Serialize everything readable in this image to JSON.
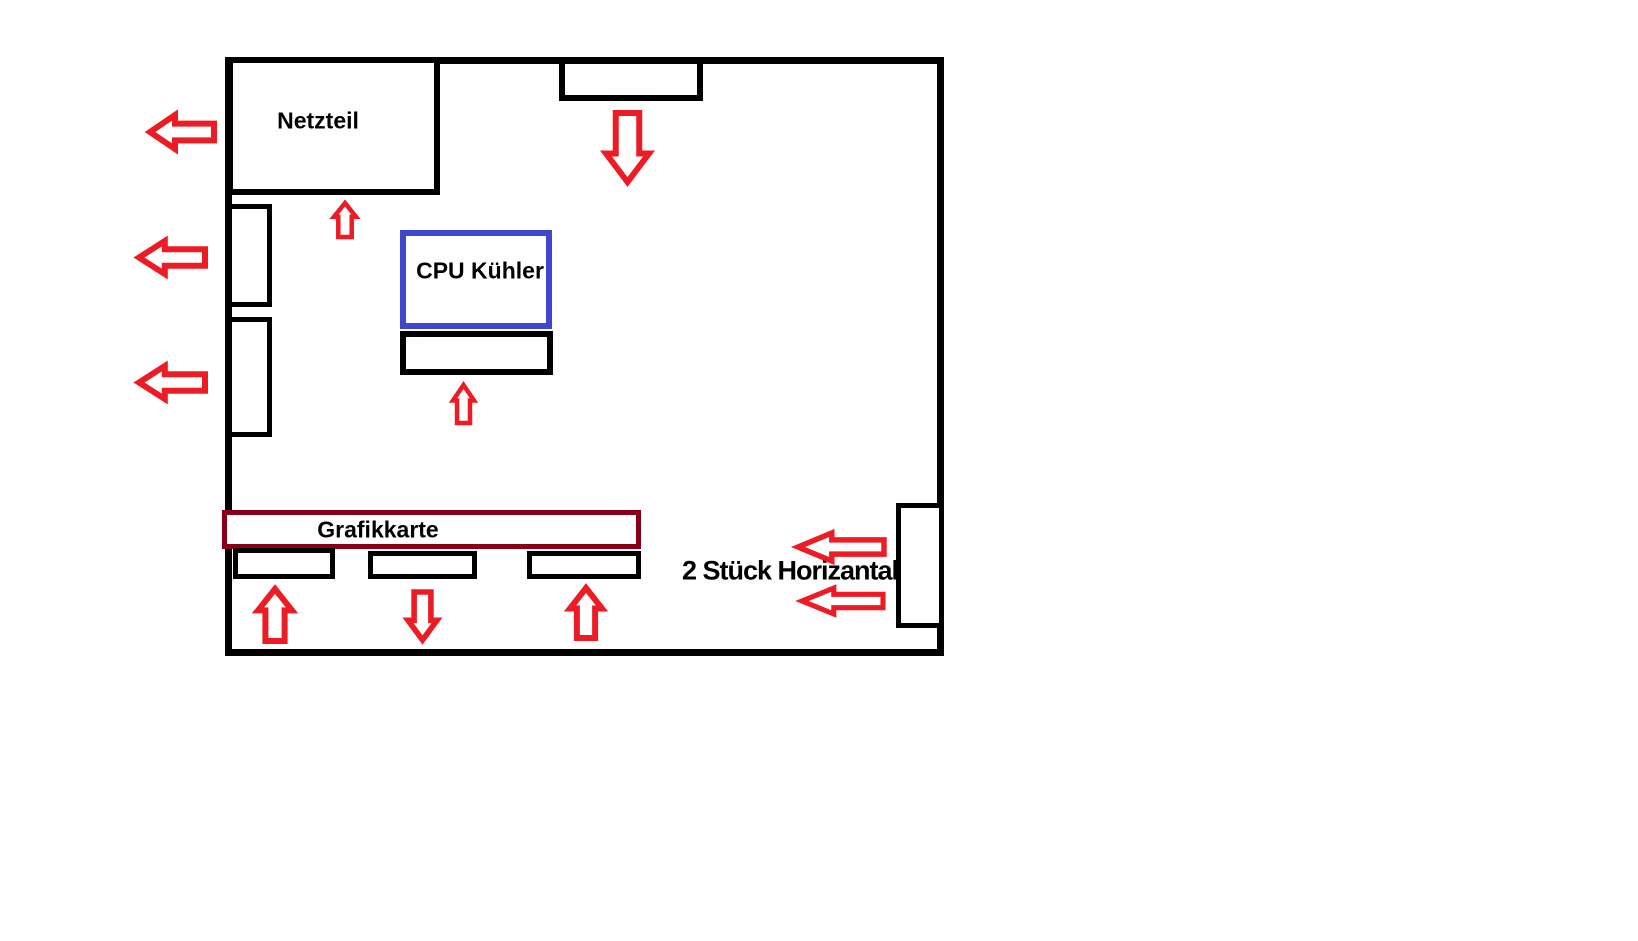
{
  "diagram": {
    "title": "pc-case-airflow-sketch",
    "labels": {
      "psu": "Netzteil",
      "cpu_cooler": "CPU Kühler",
      "gpu": "Grafikkarte",
      "side_note": "2 Stück Horizantal"
    },
    "colors": {
      "outline": "#000000",
      "arrow_red": "#ED1C24",
      "cpu_box_blue": "#3F48CC",
      "gpu_box_dark_red": "#880015",
      "background": "#FFFFFF"
    },
    "arrows": [
      {
        "id": "left-top",
        "direction": "left",
        "meaning": "exhaust out left side near PSU"
      },
      {
        "id": "left-middle",
        "direction": "left",
        "meaning": "exhaust out left vent upper"
      },
      {
        "id": "left-bottom",
        "direction": "left",
        "meaning": "exhaust out left vent lower"
      },
      {
        "id": "psu-up",
        "direction": "up",
        "meaning": "air into PSU from below"
      },
      {
        "id": "top-fan-down",
        "direction": "down",
        "meaning": "intake down from top fan"
      },
      {
        "id": "cpu-up",
        "direction": "up",
        "meaning": "air up into CPU cooler"
      },
      {
        "id": "bottom-1-up",
        "direction": "up",
        "meaning": "intake up at bottom fan 1"
      },
      {
        "id": "bottom-2-down",
        "direction": "down",
        "meaning": "air down at bottom fan 2"
      },
      {
        "id": "bottom-3-up",
        "direction": "up",
        "meaning": "intake up at bottom fan 3"
      },
      {
        "id": "right-upper-in",
        "direction": "left",
        "meaning": "intake in from right fan (1 of 2)"
      },
      {
        "id": "right-lower-in",
        "direction": "left",
        "meaning": "intake in from right fan (2 of 2)"
      }
    ]
  }
}
